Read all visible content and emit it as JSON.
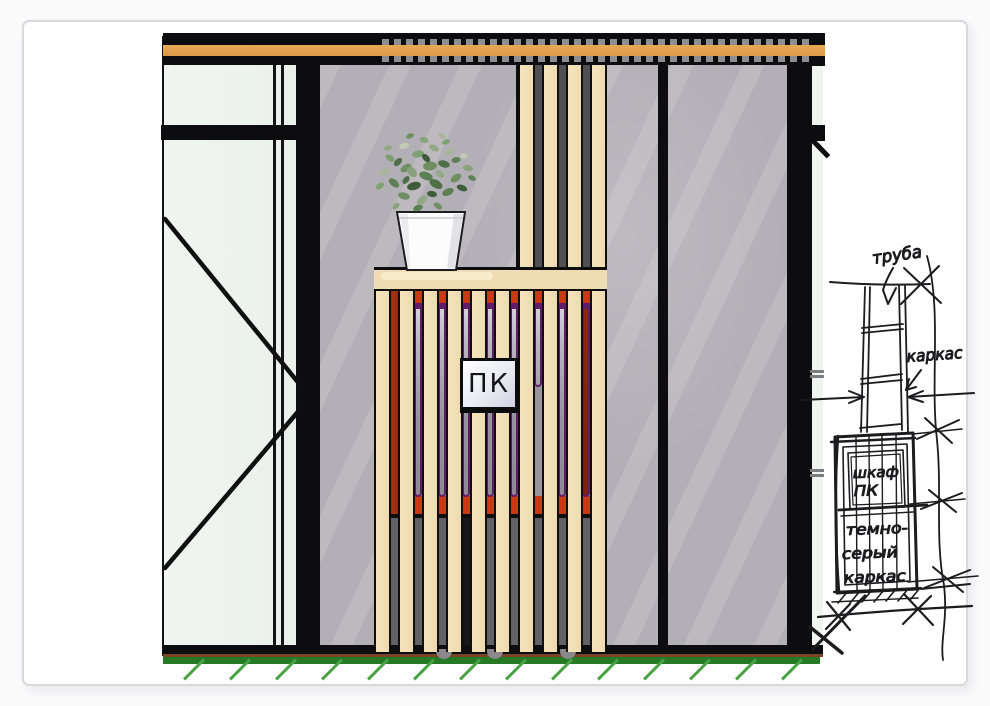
{
  "drawing": {
    "cabinet_label": "ПК"
  },
  "sketch": {
    "label_pipe": "труба",
    "label_frame": "каркас",
    "label_cabinet_line1": "шкаф",
    "label_cabinet_line2": "ПК",
    "label_dark_line1": "темно-",
    "label_dark_line2": "серый",
    "label_dark_line3": "каркас"
  },
  "palette": {
    "beam_orange": "#E2A050",
    "slat_tan": "#F2E0B8",
    "wall_gray": "#B3AFB6",
    "frame_black": "#0D0D0F",
    "cabinet_red": "#C23D12",
    "cabinet_dark_red": "#93290F",
    "pipe_purple": "#5E1C6A",
    "pipe_metal": "#B3B0B8",
    "glass_green": "#EDF2ED",
    "ground_green": "#267A26",
    "hatch_green": "#49A342",
    "label_bg": "#F7F7FC"
  }
}
